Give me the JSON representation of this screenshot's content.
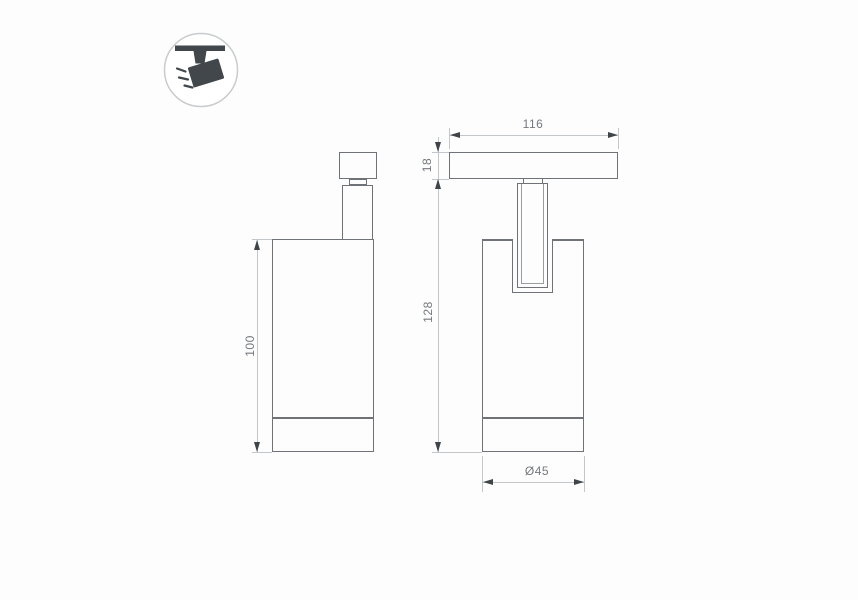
{
  "icon": {
    "name": "track-spotlight"
  },
  "dimensions": {
    "side_body_height": "100",
    "front_plate_width": "116",
    "front_plate_thickness": "18",
    "front_overall_height": "128",
    "body_diameter": "Ø45"
  },
  "colors": {
    "outline": "#6f7276",
    "inner_line": "#9a9da0",
    "dimension_line": "#c4c7ca",
    "arrow": "#3f4449",
    "text": "#75797d",
    "icon_fill": "#42474c",
    "icon_circle_stroke": "#c9ccce",
    "background": "#fdfdfd"
  }
}
